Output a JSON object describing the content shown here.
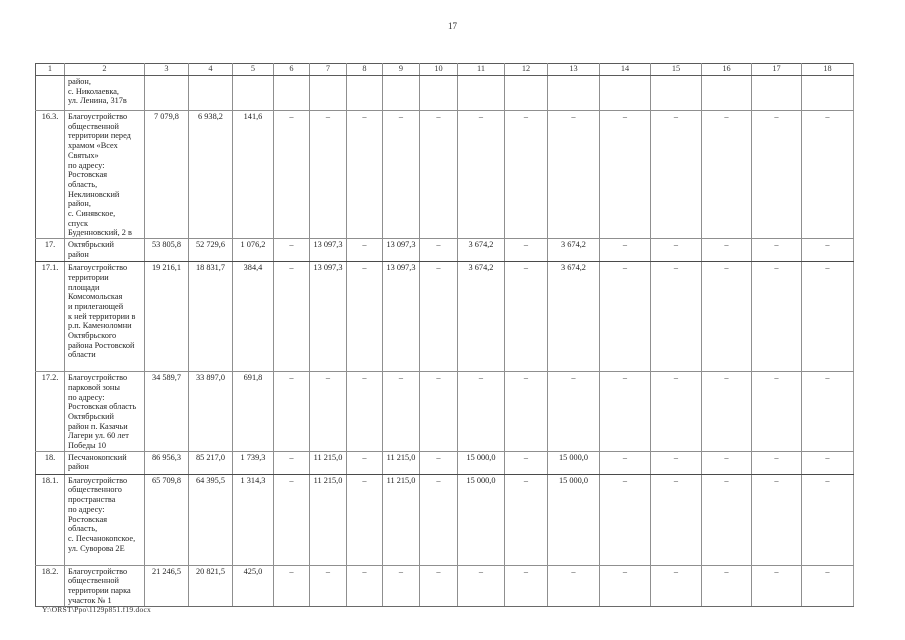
{
  "page": {
    "number": "17",
    "footer": "Y:\\ORST\\Ppo\\1129p851.f19.docx"
  },
  "table": {
    "column_numbers": [
      "1",
      "2",
      "3",
      "4",
      "5",
      "6",
      "7",
      "8",
      "9",
      "10",
      "11",
      "12",
      "13",
      "14",
      "15",
      "16",
      "17",
      "18"
    ],
    "rows": [
      {
        "kind": "continuation",
        "num": "",
        "name": "район,\nс. Николаевка,\nул. Ленина, 317в",
        "values": [
          "",
          "",
          "",
          "",
          "",
          "",
          "",
          "",
          "",
          "",
          "",
          "",
          "",
          "",
          "",
          ""
        ]
      },
      {
        "kind": "object",
        "num": "16.3.",
        "name": "Благоустройство\nобщественной\nтерритории перед\nхрамом «Всех\nСвятых»\nпо адресу:\nРостовская\nобласть,\nНеклиновский\nрайон,\nс. Синявское,\nспуск\nБуденновский, 2 в",
        "values": [
          "7 079,8",
          "6 938,2",
          "141,6",
          "–",
          "–",
          "–",
          "–",
          "–",
          "–",
          "–",
          "–",
          "–",
          "–",
          "–",
          "–",
          "–"
        ]
      },
      {
        "kind": "district",
        "num": "17.",
        "name": "Октябрьский\nрайон",
        "values": [
          "53 805,8",
          "52 729,6",
          "1 076,2",
          "–",
          "13 097,3",
          "–",
          "13 097,3",
          "–",
          "3 674,2",
          "–",
          "3 674,2",
          "–",
          "–",
          "–",
          "–",
          "–"
        ]
      },
      {
        "kind": "object",
        "num": "17.1.",
        "name": "Благоустройство\nтерритории\nплощади\nКомсомольская\nи прилегающей\nк ней территории в\nр.п. Каменоломни\nОктябрьского\nрайона Ростовской\nобласти",
        "values": [
          "19 216,1",
          "18 831,7",
          "384,4",
          "–",
          "13 097,3",
          "–",
          "13 097,3",
          "–",
          "3 674,2",
          "–",
          "3 674,2",
          "–",
          "–",
          "–",
          "–",
          "–"
        ]
      },
      {
        "kind": "object",
        "num": "17.2.",
        "name": "Благоустройство\nпарковой зоны\nпо адресу:\nРостовская область\nОктябрьский\nрайон п. Казачьи\nЛагери ул. 60 лет\nПобеды 10",
        "values": [
          "34 589,7",
          "33 897,0",
          "691,8",
          "–",
          "–",
          "–",
          "–",
          "–",
          "–",
          "–",
          "–",
          "–",
          "–",
          "–",
          "–",
          "–"
        ]
      },
      {
        "kind": "district",
        "num": "18.",
        "name": "Песчанокопский\nрайон",
        "values": [
          "86 956,3",
          "85 217,0",
          "1 739,3",
          "–",
          "11 215,0",
          "–",
          "11 215,0",
          "–",
          "15 000,0",
          "–",
          "15 000,0",
          "–",
          "–",
          "–",
          "–",
          "–"
        ]
      },
      {
        "kind": "object",
        "num": "18.1.",
        "name": "Благоустройство\nобщественного\nпространства\nпо адресу:\nРостовская\nобласть,\nс. Песчанокопское,\nул. Суворова 2Е",
        "values": [
          "65 709,8",
          "64 395,5",
          "1 314,3",
          "–",
          "11 215,0",
          "–",
          "11 215,0",
          "–",
          "15 000,0",
          "–",
          "15 000,0",
          "–",
          "–",
          "–",
          "–",
          "–"
        ]
      },
      {
        "kind": "object",
        "num": "18.2.",
        "name": "Благоустройство\nобщественной\nтерритории парка\nучасток № 1",
        "values": [
          "21 246,5",
          "20 821,5",
          "425,0",
          "–",
          "–",
          "–",
          "–",
          "–",
          "–",
          "–",
          "–",
          "–",
          "–",
          "–",
          "–",
          "–"
        ]
      }
    ]
  }
}
